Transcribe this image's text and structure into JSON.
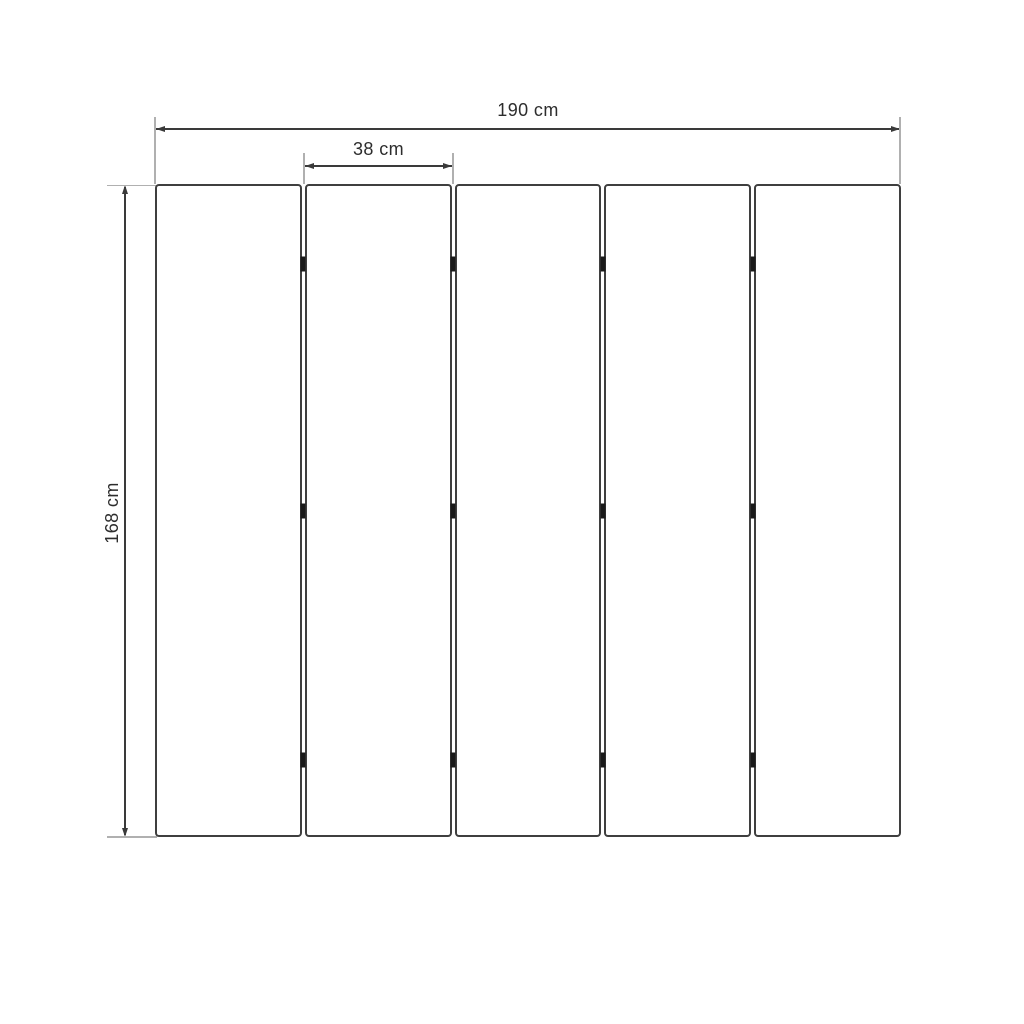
{
  "diagram": {
    "background_color": "#ffffff",
    "dimension_line_color": "#3a3a3a",
    "extension_line_color": "#b0b0b0",
    "text_color": "#2d2d2d",
    "panels": {
      "count": 5,
      "fill_color": "#ffffff",
      "border_color": "#3f3f3f"
    },
    "hinges": {
      "color": "#1a1a1a",
      "joints": 4,
      "per_joint": 3
    },
    "labels": {
      "total_width": "190 cm",
      "panel_width": "38 cm",
      "height": "168 cm"
    }
  }
}
